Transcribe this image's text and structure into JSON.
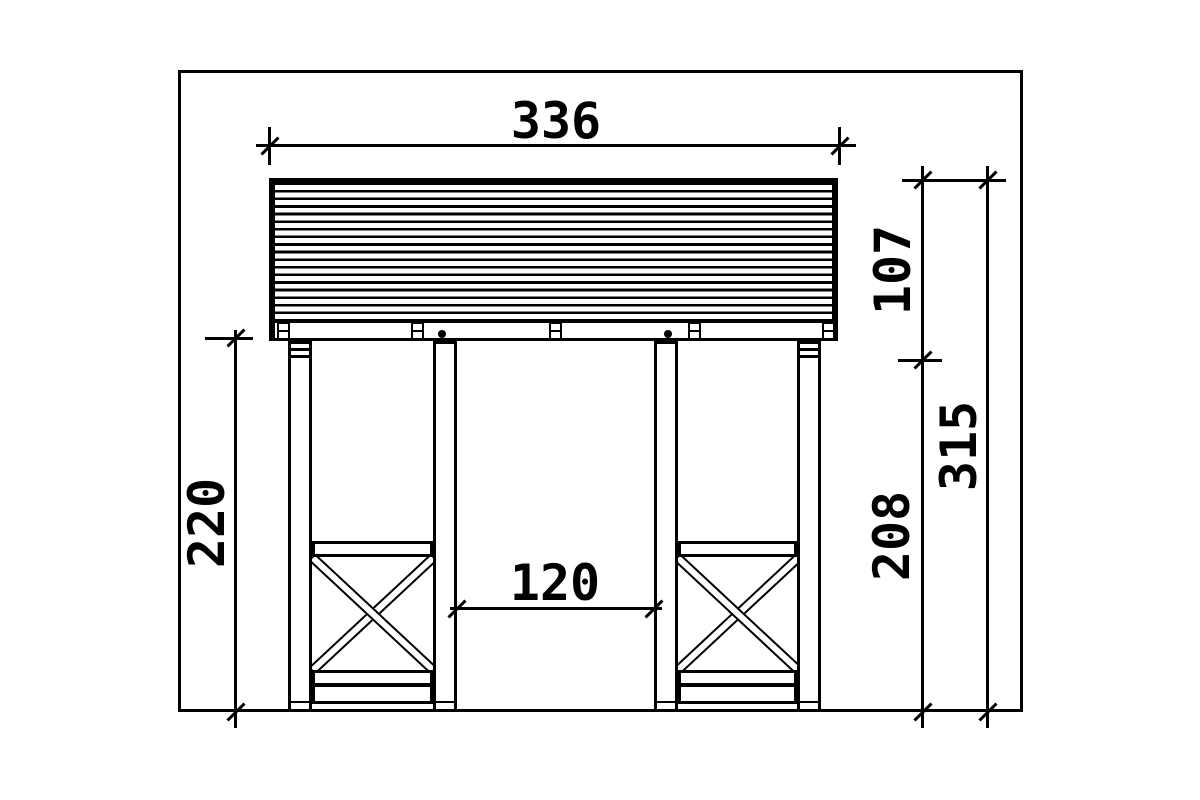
{
  "colors": {
    "line": "#000000",
    "background": "#ffffff"
  },
  "dimensions": {
    "overall_width": "336",
    "roof_height": "107",
    "total_height": "315",
    "frame_height": "208",
    "clearance_height": "220",
    "opening_width": "120"
  }
}
